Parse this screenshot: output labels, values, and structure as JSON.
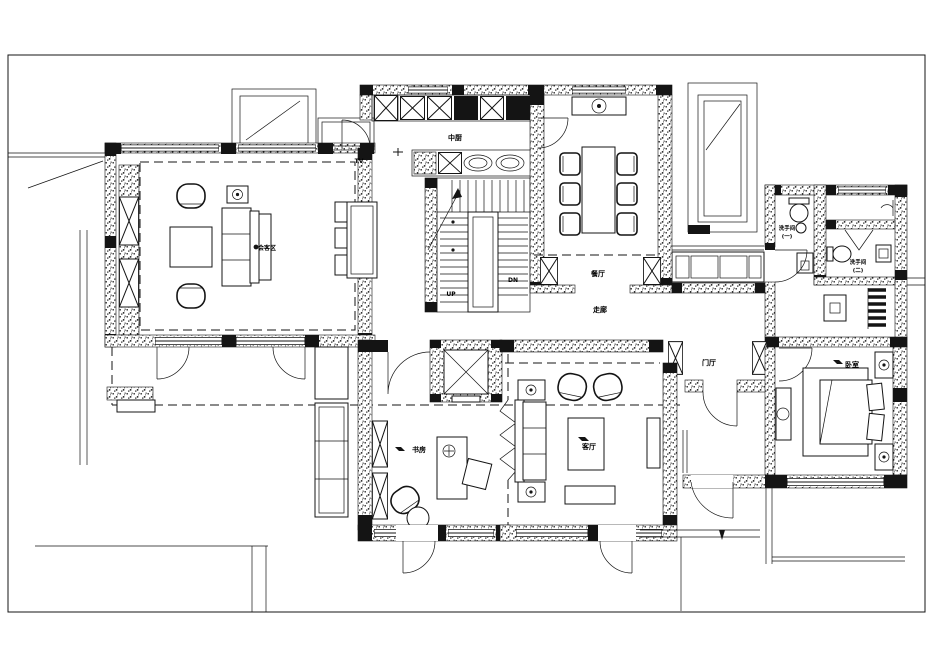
{
  "document": {
    "type": "residential-floor-plan"
  },
  "colors": {
    "ink": "#141414",
    "background": "#ffffff"
  },
  "floor_plan": {
    "rooms": {
      "reception": "会客区",
      "kitchen": "中厨",
      "dining": "餐厅",
      "corridor": "走廊",
      "foyer": "门厅",
      "washroom1_l1": "洗手间",
      "washroom1_l2": "(一)",
      "washroom2_l1": "洗手间",
      "washroom2_l2": "(二)",
      "study": "书房",
      "living": "客厅",
      "bedroom": "卧室"
    },
    "annotations": {
      "tv": "TV",
      "up": "UP",
      "dn": "DN"
    }
  }
}
